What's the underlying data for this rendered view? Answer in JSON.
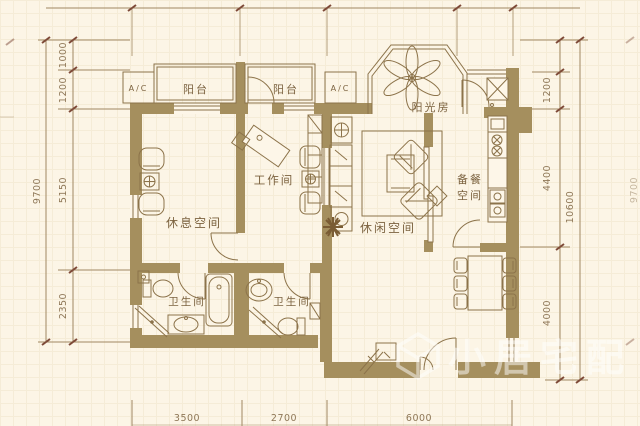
{
  "colors": {
    "background": "#fcf5e6",
    "wall": "#a58f5e",
    "line": "#8c734a",
    "room_label": "#7c6340",
    "dimension_text": "#8f7858",
    "tick": "#7e4a38",
    "watermark": "#ffffff"
  },
  "rooms": {
    "balcony_left": "阳台",
    "balcony_right": "阳台",
    "ac_left": "A/C",
    "ac_right": "A/C",
    "sunroom": "阳光房",
    "workroom": "工作间",
    "rest_space": "休息空间",
    "leisure_space": "休闲空间",
    "prep_line1": "备餐",
    "prep_line2": "空间",
    "bathroom_left": "卫生间",
    "bathroom_right": "卫生间"
  },
  "dimensions": {
    "left_total": "9700",
    "left_segments": [
      "1000",
      "1200",
      "5150",
      "2350"
    ],
    "right_segments": [
      "1200",
      "4400",
      "4000"
    ],
    "right_total": "10600",
    "right_outer_total": "9700",
    "bottom_segments": [
      "3500",
      "2700",
      "6000"
    ]
  },
  "watermark": {
    "text": "小居宅配",
    "logo": "cube-logo"
  }
}
